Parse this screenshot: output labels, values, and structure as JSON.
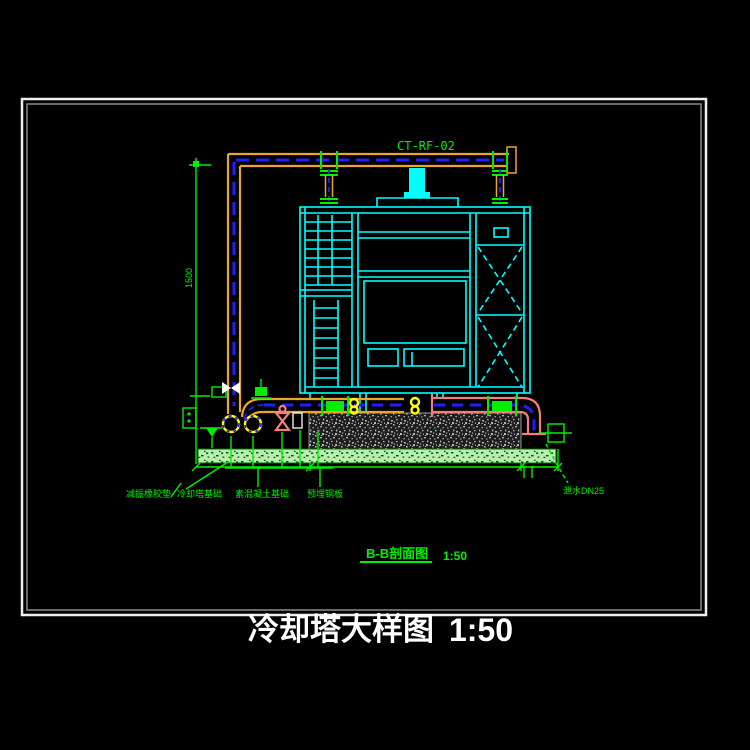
{
  "drawing": {
    "pipe_tag": "CT-RF-02",
    "title": "冷却塔大样图",
    "title_scale": "1:50",
    "section_label": "B-B剖面图",
    "section_scale": "1:50",
    "dim_left": "1500",
    "labels": {
      "vibration_pad": "减振橡胶垫",
      "tower_foundation": "冷却塔基础",
      "concrete_base": "素混凝土基础",
      "embed_plate": "预埋钢板",
      "drain": "泄水DN25"
    },
    "colors": {
      "background": "#000000",
      "frame": "#efefef",
      "tower": "#00ffff",
      "pipe_supply": "#eaa62a",
      "pipe_return": "#f08080",
      "centerline": "#2020ff",
      "annotation": "#00ef00",
      "fitting": "#ffff00",
      "valve_white": "#ffffff",
      "concrete_hatch": "#b5b5b5",
      "ground_hatch": "#b7f0ae",
      "title_text": "#ffffff"
    }
  }
}
